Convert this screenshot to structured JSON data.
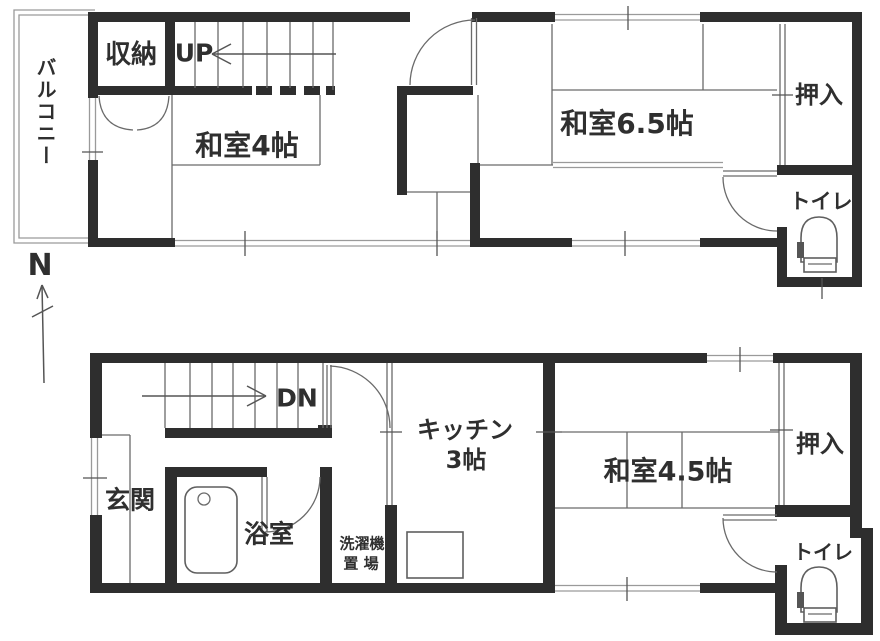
{
  "title": "floor-plan",
  "colors": {
    "wall": "#2e2e2e",
    "line": "#6a6a6a",
    "winline": "#9a9a9a",
    "text": "#2f2f2f",
    "bg": "#ffffff"
  },
  "compass": {
    "north_label": "N"
  },
  "upper_floor": {
    "rooms": {
      "balcony": "バルコニー",
      "storage": "収納",
      "stairs_direction": "UP",
      "washitsu_4": "和室4帖",
      "washitsu_65": "和室6.5帖",
      "oshiire": "押入",
      "toilet": "トイレ"
    }
  },
  "lower_floor": {
    "rooms": {
      "genkan": "玄関",
      "stairs_direction": "DN",
      "bathroom": "浴室",
      "laundry_line1": "洗濯機",
      "laundry_line2": "置 場",
      "kitchen_line1": "キッチン",
      "kitchen_line2": "3帖",
      "washitsu_45": "和室4.5帖",
      "oshiire": "押入",
      "toilet": "トイレ"
    }
  },
  "icons": {
    "toilet_upper": "toilet-icon",
    "toilet_lower": "toilet-icon",
    "bathtub": "bathtub-icon",
    "kitchen_sink": "kitchen-sink-icon",
    "north_arrow": "north-arrow-icon",
    "stairs_up": "stairs-up-icon",
    "stairs_down": "stairs-down-icon"
  }
}
